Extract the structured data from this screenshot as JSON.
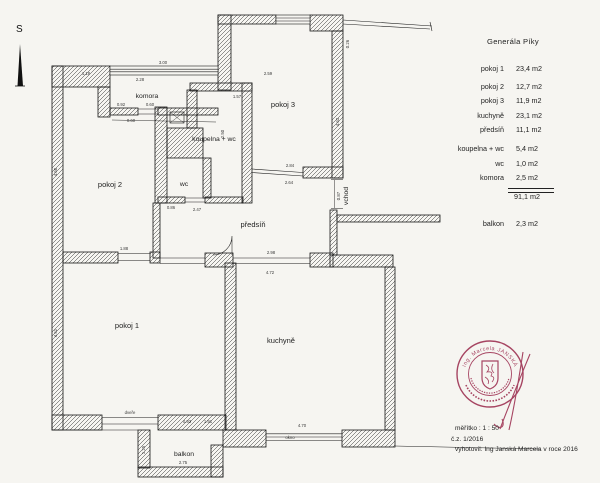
{
  "north": {
    "label": "S"
  },
  "legend": {
    "title": "Generála Píky",
    "rows": [
      {
        "label": "pokoj 1",
        "value": "23,4 m2"
      },
      {
        "label": "pokoj 2",
        "value": "12,7 m2"
      },
      {
        "label": "pokoj 3",
        "value": "11,9 m2"
      },
      {
        "label": "kuchyně",
        "value": "23,1 m2"
      },
      {
        "label": "předsíň",
        "value": "11,1 m2"
      },
      {
        "label": "koupelna + wc",
        "value": "5,4 m2"
      },
      {
        "label": "wc",
        "value": "1,0 m2"
      },
      {
        "label": "komora",
        "value": "2,5 m2"
      }
    ],
    "total": "91,1 m2",
    "balcony_row": {
      "label": "balkon",
      "value": "2,3 m2"
    }
  },
  "plan": {
    "rooms": [
      {
        "name": "komora"
      },
      {
        "name": "pokoj 2"
      },
      {
        "name": "pokoj 3"
      },
      {
        "name": "koupelna + wc"
      },
      {
        "name": "wc"
      },
      {
        "name": "předsíň"
      },
      {
        "name": "pokoj 1"
      },
      {
        "name": "kuchyně"
      },
      {
        "name": "balkon"
      },
      {
        "name": "vchod"
      }
    ],
    "dims": [
      {
        "t": "1.18"
      },
      {
        "t": "3.00"
      },
      {
        "t": "2.28"
      },
      {
        "t": "2.59"
      },
      {
        "t": "0.26"
      },
      {
        "t": "4.63"
      },
      {
        "t": "1.57"
      },
      {
        "t": "2.50"
      },
      {
        "t": "0.92"
      },
      {
        "t": "0.60"
      },
      {
        "t": "0.60"
      },
      {
        "t": "2.84"
      },
      {
        "t": "2.64"
      },
      {
        "t": "0.87"
      },
      {
        "t": "2.47"
      },
      {
        "t": "0.86"
      },
      {
        "t": "4.52"
      },
      {
        "t": "4.58"
      },
      {
        "t": "4.72"
      },
      {
        "t": "2.98"
      },
      {
        "t": "4.70"
      },
      {
        "t": "1.88"
      },
      {
        "t": "2.75"
      },
      {
        "t": "1.25"
      },
      {
        "t": "1.91"
      },
      {
        "t": "0.93"
      },
      {
        "t": "dveře"
      },
      {
        "t": "okno"
      }
    ]
  },
  "stamp": {
    "name": "Ing. Marcela JANSKÁ",
    "color": "#9c2d4f"
  },
  "footer": {
    "scale": "měřítko : 1 : 50",
    "ref": "č.z. 1/2016",
    "author": "vyhotovil: Ing Janská Marcela v roce 2016"
  }
}
